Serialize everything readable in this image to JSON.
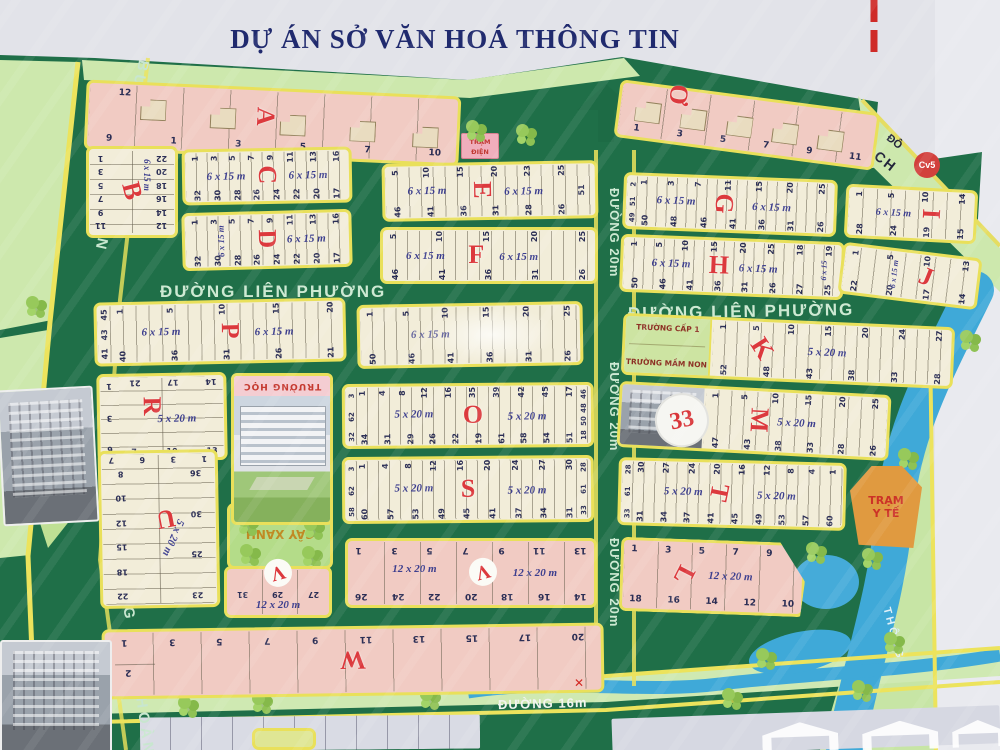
{
  "title": "DỰ ÁN SỞ VĂN HOÁ THÔNG TIN",
  "roads": {
    "lien_phuong": "ĐƯỜNG LIÊN PHƯỜNG",
    "duong20": "ĐƯỜNG 20m",
    "duong16": "ĐƯỜNG 16m",
    "bung_ong_thoan": "BƯNG ÔNG THOÀN",
    "rach_line1": "ĐÔ",
    "rach_line2": "RẠCH",
    "river": "THÔNG"
  },
  "badges": {
    "cv5": "Cv5",
    "block33": "33"
  },
  "marks": {
    "x": "✕"
  },
  "facilities": {
    "tram_dien_1": "TRẠM",
    "tram_dien_2": "ĐIỆN",
    "truong_hoc": "TRƯỜNG HỌC",
    "truong_cap1": "TRƯỜNG CẤP 1",
    "truong_mam_non": "TRƯỜNG MẦM NON",
    "tdtt": "TDTT",
    "cay_xanh": "CÂY XANH",
    "tram_y_te_1": "TRẠM",
    "tram_y_te_2": "Y TẾ"
  },
  "blocks": {
    "A": {
      "letter": "A",
      "n12": "12",
      "numbers": [
        "9",
        "1",
        "3",
        "5",
        "7",
        "10"
      ]
    },
    "O2": {
      "letter": "Ơ",
      "numbers": [
        "1",
        "3",
        "5",
        "7",
        "9",
        "11"
      ]
    },
    "B": {
      "letter": "B",
      "dim": "6 x 15 m",
      "left": [
        "1",
        "3",
        "5",
        "7",
        "9",
        "11"
      ],
      "right": [
        "22",
        "20",
        "18",
        "16",
        "14",
        "12"
      ]
    },
    "C": {
      "letter": "C",
      "dims": [
        "6 x 15 m",
        "6 x 15 m"
      ],
      "top": [
        "1",
        "3",
        "5",
        "7",
        "9",
        "11",
        "13",
        "16"
      ],
      "bottom": [
        "32",
        "30",
        "28",
        "26",
        "24",
        "22",
        "20",
        "17"
      ]
    },
    "D": {
      "letter": "D",
      "dims": [
        "6 x 15 m",
        "6 x 15 m"
      ],
      "top": [
        "1",
        "3",
        "5",
        "7",
        "9",
        "11",
        "13",
        "16"
      ],
      "bottom": [
        "32",
        "30",
        "28",
        "26",
        "24",
        "22",
        "20",
        "17"
      ]
    },
    "E": {
      "letter": "E",
      "dims": [
        "6 x 15 m",
        "6 x 15 m"
      ],
      "extra": "51",
      "top": [
        "5",
        "10",
        "15",
        "20",
        "23",
        "25"
      ],
      "bottom": [
        "46",
        "41",
        "36",
        "31",
        "28",
        "26"
      ]
    },
    "F": {
      "letter": "F",
      "dims": [
        "6 x 15 m",
        "6 x 15 m"
      ],
      "top": [
        "5",
        "10",
        "15",
        "20",
        "25"
      ],
      "bottom": [
        "46",
        "41",
        "36",
        "31",
        "26"
      ]
    },
    "G": {
      "letter": "G",
      "dims": [
        "6 x 15 m",
        "6 x 15 m"
      ],
      "left": [
        "2",
        "51",
        "49"
      ],
      "top": [
        "1",
        "3",
        "7",
        "11",
        "15",
        "20",
        "25"
      ],
      "bottom": [
        "50",
        "48",
        "46",
        "41",
        "36",
        "31",
        "26"
      ]
    },
    "H": {
      "letter": "H",
      "dims": [
        "6 x 15 m",
        "6 x 15 m",
        "6 x 15"
      ],
      "top": [
        "1",
        "5",
        "10",
        "15",
        "20",
        "25",
        "18",
        "19"
      ],
      "bottom": [
        "50",
        "46",
        "41",
        "36",
        "31",
        "26",
        "27",
        "25"
      ]
    },
    "I": {
      "letter": "I",
      "dim": "6 x 15 m",
      "top": [
        "1",
        "5",
        "10",
        "14"
      ],
      "bottom": [
        "28",
        "24",
        "19",
        "15"
      ]
    },
    "J": {
      "letter": "J",
      "dim": "6 x 15 m",
      "top": [
        "1",
        "5",
        "10",
        "13"
      ],
      "bottom": [
        "22",
        "20",
        "17",
        "14"
      ]
    },
    "P": {
      "letter": "P",
      "dims": [
        "6 x 15 m",
        "6 x 15 m"
      ],
      "left": [
        "45",
        "43",
        "41"
      ],
      "top": [
        "1",
        "5",
        "10",
        "15",
        "20"
      ],
      "bottom": [
        "40",
        "36",
        "31",
        "26",
        "21"
      ]
    },
    "Q": {
      "dim": "6 x 15 m",
      "top": [
        "1",
        "5",
        "10",
        "15",
        "20",
        "25"
      ],
      "bottom": [
        "50",
        "46",
        "41",
        "36",
        "31",
        "26"
      ]
    },
    "K": {
      "letter": "K",
      "dim": "5 x 20 m",
      "top": [
        "1",
        "5",
        "10",
        "15",
        "20",
        "24",
        "27"
      ],
      "bottom": [
        "52",
        "48",
        "43",
        "38",
        "33",
        "28"
      ]
    },
    "R": {
      "letter": "R",
      "dim": "5 x 20 m",
      "left": [
        "1",
        "3",
        "6"
      ],
      "top": [
        "21",
        "17",
        "14"
      ],
      "bottom": [
        "7",
        "10",
        "13"
      ]
    },
    "O": {
      "letter": "O",
      "dims": [
        "5 x 20 m",
        "5 x 20 m"
      ],
      "left": [
        "3",
        "62",
        "32"
      ],
      "right": [
        "46",
        "48",
        "50",
        "18"
      ],
      "top": [
        "1",
        "4",
        "8",
        "12",
        "16",
        "35",
        "39",
        "42",
        "45",
        "17"
      ],
      "bottom": [
        "34",
        "31",
        "29",
        "26",
        "22",
        "19",
        "61",
        "58",
        "54",
        "51"
      ]
    },
    "M": {
      "letter": "M",
      "dim": "5 x 20 m",
      "top": [
        "1",
        "5",
        "10",
        "15",
        "20",
        "25"
      ],
      "bottom": [
        "47",
        "43",
        "38",
        "33",
        "28",
        "26"
      ]
    },
    "S": {
      "letter": "S",
      "dims": [
        "5 x 20 m",
        "5 x 20 m"
      ],
      "left": [
        "3",
        "62",
        "58"
      ],
      "right": [
        "28",
        "61",
        "33"
      ],
      "top": [
        "1",
        "4",
        "8",
        "12",
        "16",
        "20",
        "24",
        "27",
        "30"
      ],
      "bottom": [
        "60",
        "57",
        "53",
        "49",
        "45",
        "41",
        "37",
        "34",
        "31"
      ]
    },
    "T": {
      "letter": "T",
      "dims": [
        "5 x 20 m",
        "5 x 20 m"
      ],
      "left": [
        "28",
        "61",
        "33"
      ],
      "top": [
        "30",
        "27",
        "24",
        "20",
        "16",
        "12",
        "8",
        "4",
        "1"
      ],
      "bottom": [
        "31",
        "34",
        "37",
        "41",
        "45",
        "49",
        "53",
        "57",
        "60"
      ]
    },
    "U": {
      "letter": "U",
      "dim": "5 x 20 m",
      "toprow": [
        "7",
        "6",
        "3",
        "1"
      ],
      "left": [
        "8",
        "10",
        "12",
        "15",
        "18",
        "22"
      ],
      "right": [
        "36",
        "30",
        "25",
        "23"
      ]
    },
    "V1": {
      "letter": "V",
      "dim": "12 x 20 m",
      "numbers": [
        "31",
        "29",
        "27"
      ]
    },
    "V": {
      "letter": "V",
      "dims": [
        "12 x 20 m",
        "12 x 20 m"
      ],
      "top": [
        "1",
        "3",
        "5",
        "7",
        "9",
        "11",
        "13"
      ],
      "bottom": [
        "26",
        "24",
        "22",
        "20",
        "18",
        "16",
        "14"
      ]
    },
    "L": {
      "letter": "L",
      "dim": "12 x 20 m",
      "top": [
        "1",
        "3",
        "5",
        "7",
        "9"
      ],
      "bottom": [
        "18",
        "16",
        "14",
        "12",
        "10"
      ]
    },
    "W": {
      "letter": "W",
      "n2": "2",
      "top": [
        "1",
        "3",
        "5",
        "7",
        "9",
        "11",
        "13",
        "15",
        "17",
        "20"
      ]
    }
  }
}
